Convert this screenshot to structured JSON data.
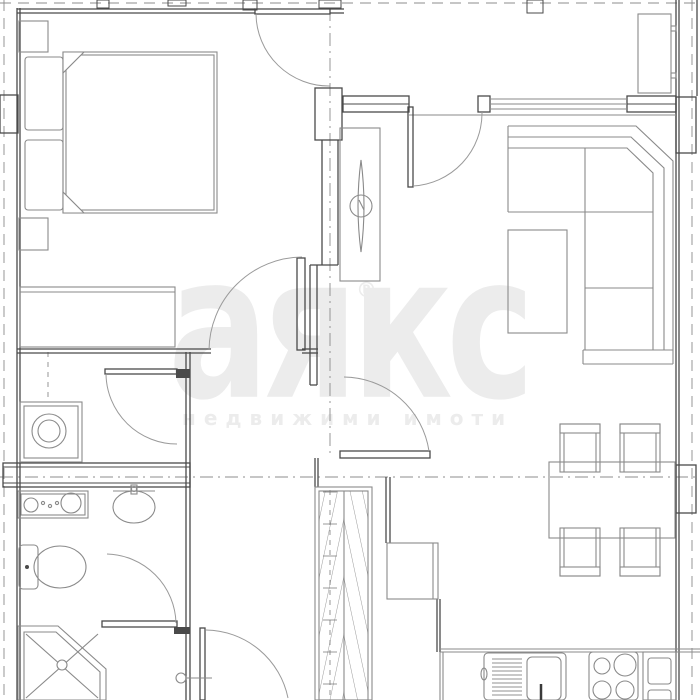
{
  "watermark": {
    "logo": "аякс",
    "registered": "®",
    "tagline": "недвижими имоти"
  },
  "palette": {
    "background": "#ffffff",
    "wall_line": "#4a4a4a",
    "furniture_line": "#8a8a8a",
    "door_line": "#9a9a9a",
    "axis_line": "#8c8c8c",
    "hatch_line": "#6e6e6e",
    "watermark_color": "#ececec"
  },
  "plan": {
    "type": "apartment-floor-plan",
    "fixtures": [
      "double-bed",
      "pillow",
      "nightstand",
      "bedroom-closet",
      "swing-door",
      "washing-machine",
      "vanity-unit",
      "wall-basin",
      "toilet",
      "corner-shower",
      "hallway-closet",
      "hallway-cabinet",
      "tv-unit",
      "corner-sofa",
      "coffee-table",
      "storage-cabinet",
      "window",
      "balcony-door",
      "dining-table",
      "dining-chair",
      "kitchen-counter",
      "kitchen-sink",
      "cooktop",
      "kitchen-column",
      "masonry-pier",
      "axis-line",
      "door-stop"
    ]
  }
}
